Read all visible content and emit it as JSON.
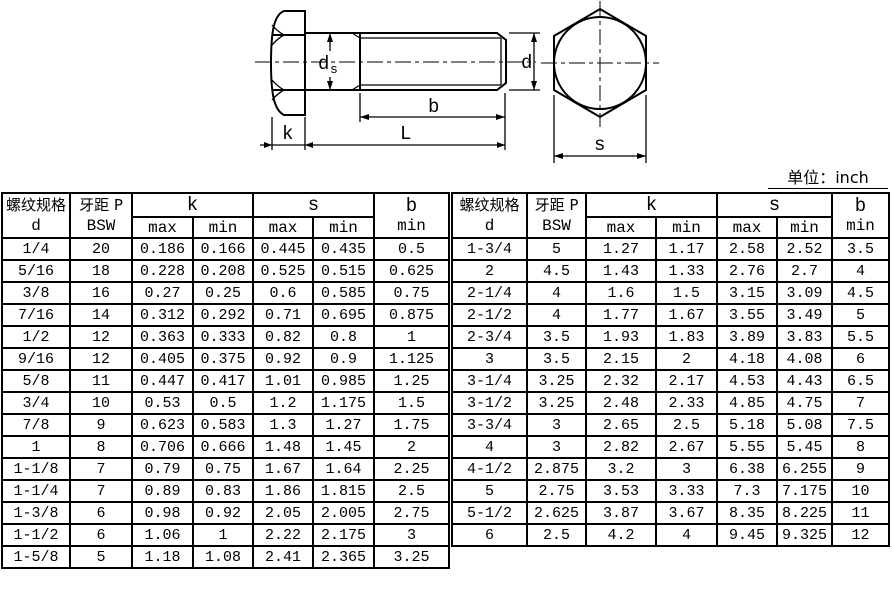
{
  "unit_label": "单位：inch",
  "drawing": {
    "side_labels": {
      "k": "k",
      "L": "L",
      "b": "b",
      "d": "d",
      "ds_base": "d",
      "ds_sub": "s"
    },
    "end_labels": {
      "s": "s"
    }
  },
  "tables": {
    "headers": {
      "col_spec_line1": "螺纹规格",
      "col_spec_line2": "d",
      "col_pitch_line1": "牙距 P",
      "col_pitch_line2": "BSW",
      "group_k": "k",
      "group_s": "s",
      "col_b_line1": "b",
      "col_b_line2": "min",
      "sub_max": "max",
      "sub_min": "min"
    },
    "left_rows": [
      [
        "1/4",
        "20",
        "0.186",
        "0.166",
        "0.445",
        "0.435",
        "0.5"
      ],
      [
        "5/16",
        "18",
        "0.228",
        "0.208",
        "0.525",
        "0.515",
        "0.625"
      ],
      [
        "3/8",
        "16",
        "0.27",
        "0.25",
        "0.6",
        "0.585",
        "0.75"
      ],
      [
        "7/16",
        "14",
        "0.312",
        "0.292",
        "0.71",
        "0.695",
        "0.875"
      ],
      [
        "1/2",
        "12",
        "0.363",
        "0.333",
        "0.82",
        "0.8",
        "1"
      ],
      [
        "9/16",
        "12",
        "0.405",
        "0.375",
        "0.92",
        "0.9",
        "1.125"
      ],
      [
        "5/8",
        "11",
        "0.447",
        "0.417",
        "1.01",
        "0.985",
        "1.25"
      ],
      [
        "3/4",
        "10",
        "0.53",
        "0.5",
        "1.2",
        "1.175",
        "1.5"
      ],
      [
        "7/8",
        "9",
        "0.623",
        "0.583",
        "1.3",
        "1.27",
        "1.75"
      ],
      [
        "1",
        "8",
        "0.706",
        "0.666",
        "1.48",
        "1.45",
        "2"
      ],
      [
        "1-1/8",
        "7",
        "0.79",
        "0.75",
        "1.67",
        "1.64",
        "2.25"
      ],
      [
        "1-1/4",
        "7",
        "0.89",
        "0.83",
        "1.86",
        "1.815",
        "2.5"
      ],
      [
        "1-3/8",
        "6",
        "0.98",
        "0.92",
        "2.05",
        "2.005",
        "2.75"
      ],
      [
        "1-1/2",
        "6",
        "1.06",
        "1",
        "2.22",
        "2.175",
        "3"
      ],
      [
        "1-5/8",
        "5",
        "1.18",
        "1.08",
        "2.41",
        "2.365",
        "3.25"
      ]
    ],
    "right_rows": [
      [
        "1-3/4",
        "5",
        "1.27",
        "1.17",
        "2.58",
        "2.52",
        "3.5"
      ],
      [
        "2",
        "4.5",
        "1.43",
        "1.33",
        "2.76",
        "2.7",
        "4"
      ],
      [
        "2-1/4",
        "4",
        "1.6",
        "1.5",
        "3.15",
        "3.09",
        "4.5"
      ],
      [
        "2-1/2",
        "4",
        "1.77",
        "1.67",
        "3.55",
        "3.49",
        "5"
      ],
      [
        "2-3/4",
        "3.5",
        "1.93",
        "1.83",
        "3.89",
        "3.83",
        "5.5"
      ],
      [
        "3",
        "3.5",
        "2.15",
        "2",
        "4.18",
        "4.08",
        "6"
      ],
      [
        "3-1/4",
        "3.25",
        "2.32",
        "2.17",
        "4.53",
        "4.43",
        "6.5"
      ],
      [
        "3-1/2",
        "3.25",
        "2.48",
        "2.33",
        "4.85",
        "4.75",
        "7"
      ],
      [
        "3-3/4",
        "3",
        "2.65",
        "2.5",
        "5.18",
        "5.08",
        "7.5"
      ],
      [
        "4",
        "3",
        "2.82",
        "2.67",
        "5.55",
        "5.45",
        "8"
      ],
      [
        "4-1/2",
        "2.875",
        "3.2",
        "3",
        "6.38",
        "6.255",
        "9"
      ],
      [
        "5",
        "2.75",
        "3.53",
        "3.33",
        "7.3",
        "7.175",
        "10"
      ],
      [
        "5-1/2",
        "2.625",
        "3.87",
        "3.67",
        "8.35",
        "8.225",
        "11"
      ],
      [
        "6",
        "2.5",
        "4.2",
        "4",
        "9.45",
        "9.325",
        "12"
      ]
    ]
  }
}
